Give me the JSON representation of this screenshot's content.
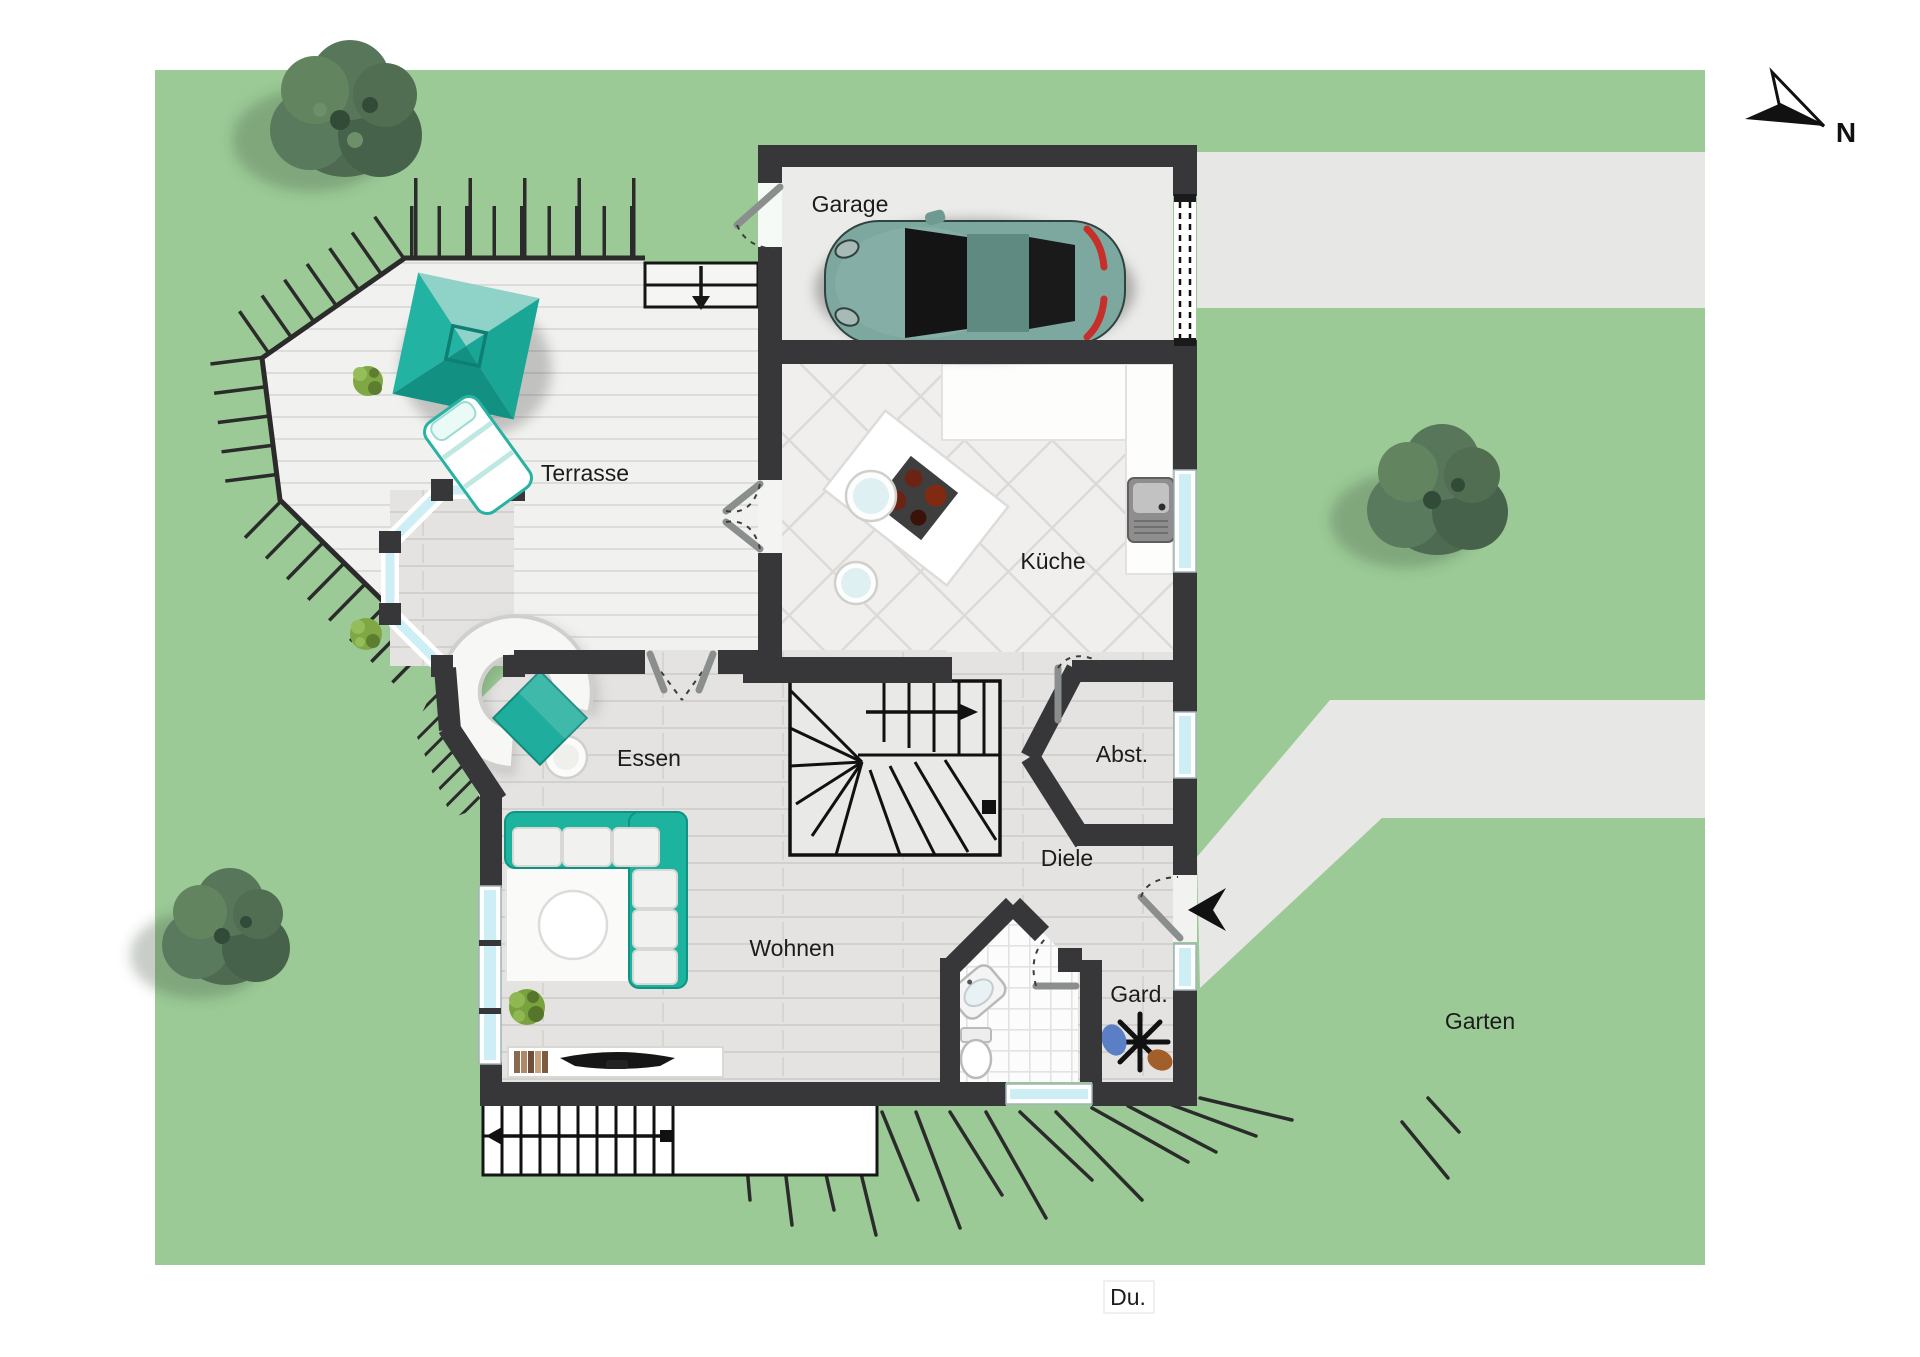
{
  "palette": {
    "lawn": "#9bca96",
    "paving": "#e7e7e5",
    "wall": "#373739",
    "accent_teal": "#1fae9d",
    "glazing": "#cdeef5",
    "interior_floor": "#e4e3e1",
    "deck": "#f1f1f0",
    "tree": "#4e6b52",
    "taillight_red": "#c62f2a"
  },
  "labels": {
    "garage": "Garage",
    "terrasse": "Terrasse",
    "kueche": "Küche",
    "essen": "Essen",
    "abst": "Abst.",
    "diele": "Diele",
    "wohnen": "Wohnen",
    "gard": "Gard.",
    "garten": "Garten",
    "du": "Du.",
    "north": "N"
  }
}
